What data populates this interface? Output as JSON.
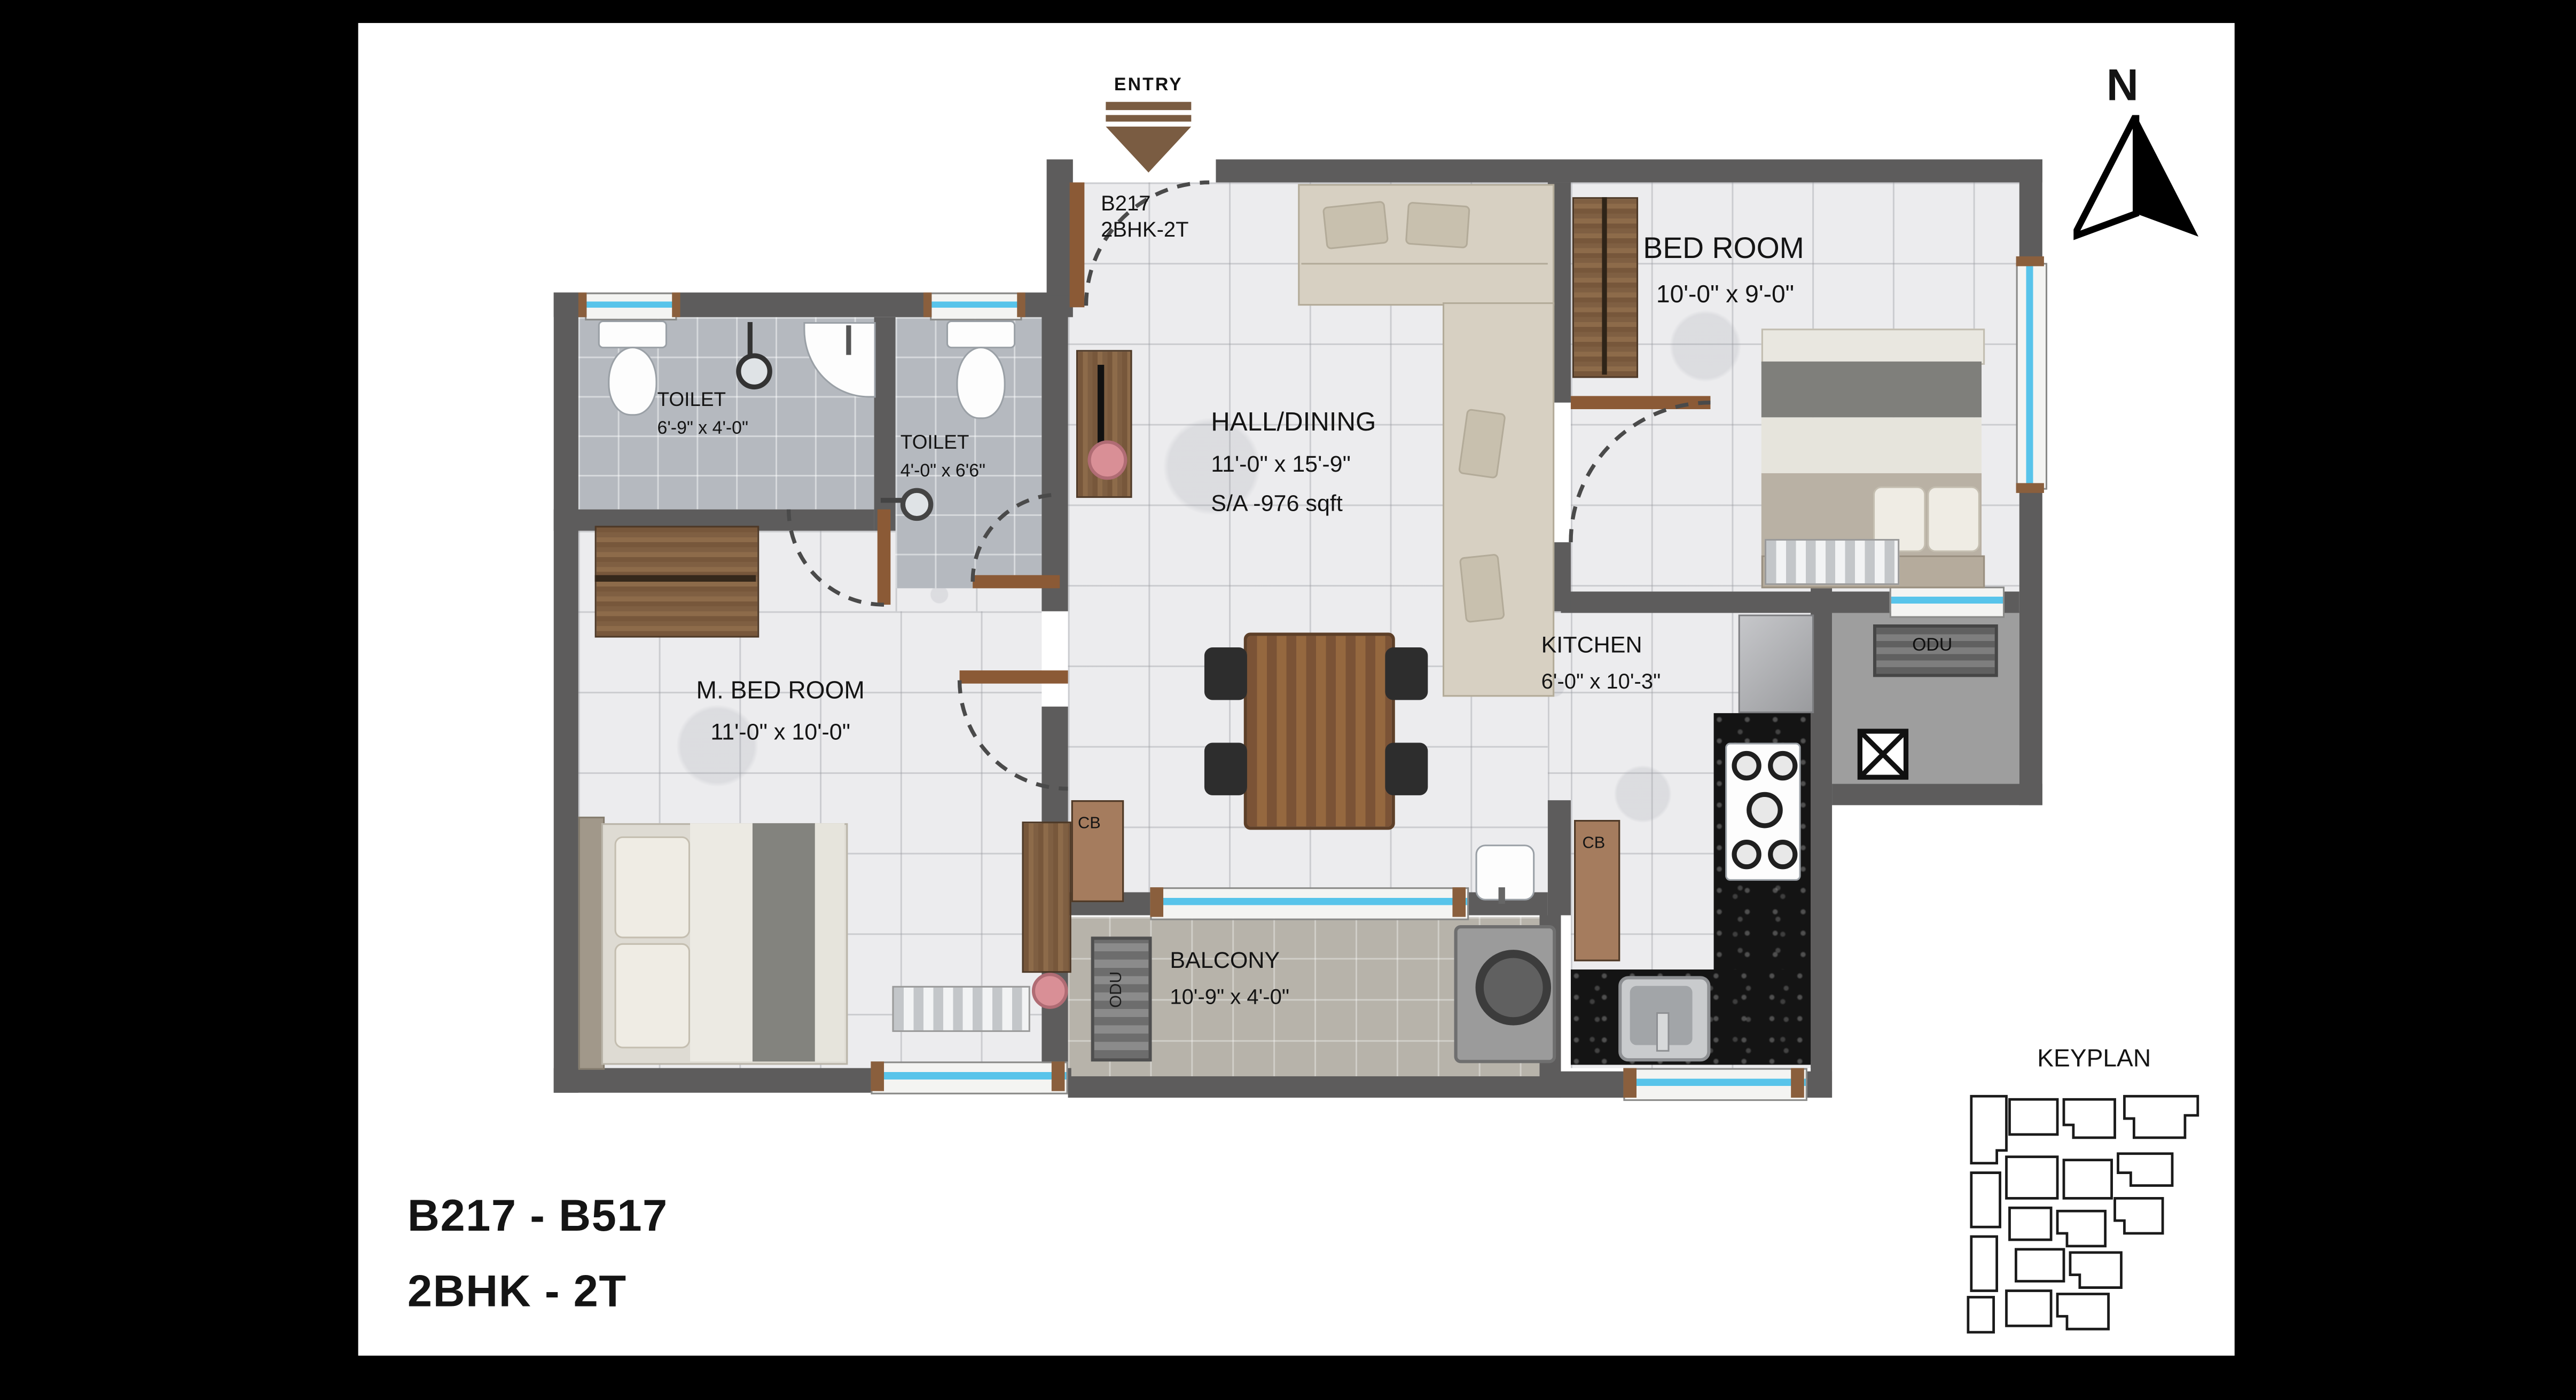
{
  "compass": {
    "label": "N"
  },
  "entry": {
    "label": "ENTRY"
  },
  "unit_tag": {
    "line1": "B217",
    "line2": "2BHK-2T"
  },
  "rooms": {
    "bedroom": {
      "name": "BED ROOM",
      "dims": "10'-0\" x 9'-0\""
    },
    "hall": {
      "name": "HALL/DINING",
      "dims": "11'-0\" x 15'-9\"",
      "area": "S/A -976 sqft"
    },
    "toilet1": {
      "name": "TOILET",
      "dims": "6'-9\" x 4'-0\""
    },
    "toilet2": {
      "name": "TOILET",
      "dims": "4'-0\" x 6'6\""
    },
    "master_bedroom": {
      "name": "M. BED ROOM",
      "dims": "11'-0\" x 10'-0\""
    },
    "kitchen": {
      "name": "KITCHEN",
      "dims": "6'-0\" x 10'-3\""
    },
    "balcony": {
      "name": "BALCONY",
      "dims": "10'-9\" x 4'-0\""
    }
  },
  "fixtures": {
    "cupboard": "CB",
    "outdoor_unit": "ODU"
  },
  "keyplan": {
    "title": "KEYPLAN"
  },
  "title_block": {
    "line1": "B217 - B517",
    "line2": "2BHK - 2T"
  },
  "colors": {
    "wall": "#5d5c5c",
    "wood": "#8a5f3d",
    "window_glass": "#58c4ea",
    "counter_granite": "#141414",
    "floor_marble": "#ececee",
    "entry_arrow": "#7a5c42"
  }
}
